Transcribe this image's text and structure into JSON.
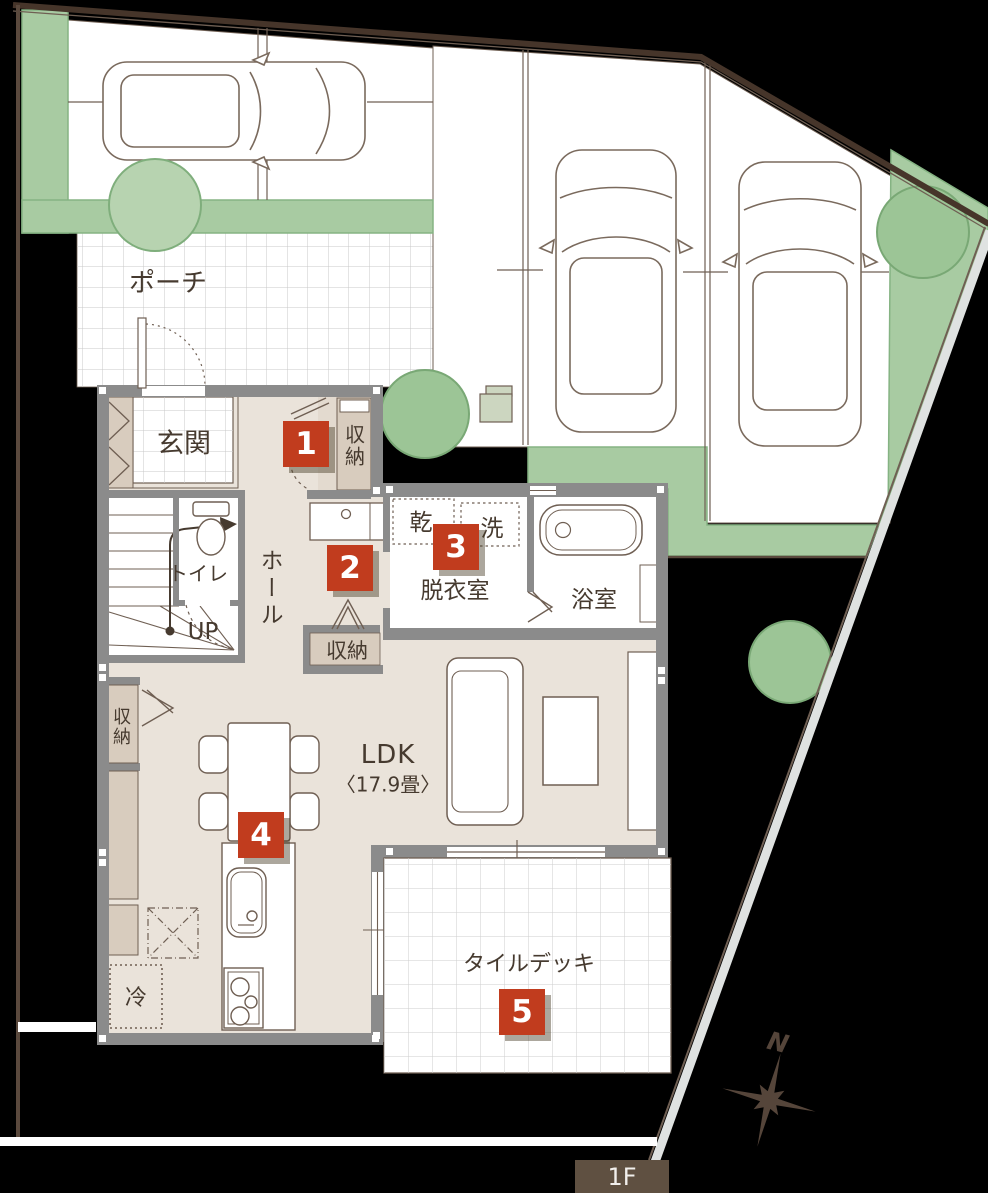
{
  "floor_badge": "1F",
  "compass": "N",
  "labels": {
    "porch": "ポーチ",
    "entrance": "玄関",
    "entrance_storage": "収納",
    "toilet": "トイレ",
    "hall": "ホール",
    "stairs": "UP",
    "dryer": "乾",
    "washer": "洗",
    "dressing_room": "脱衣室",
    "bathroom": "浴室",
    "hall_storage": "収納",
    "ldk_storage": "収納",
    "ldk": "LDK",
    "ldk_area": "〈17.9畳〉",
    "refrigerator": "冷",
    "tile_deck": "タイルデッキ"
  },
  "markers": [
    "1",
    "2",
    "3",
    "4",
    "5"
  ],
  "colors": {
    "marker_red": "#c13c1e",
    "greenery": "#a8cba2",
    "wall_gray": "#8b8b8b",
    "floor_beige": "#eae3da",
    "closet_beige": "#d8ccbe",
    "line_brown": "#6f5f53",
    "badge_brown": "#5f5041",
    "background": "#000000"
  }
}
